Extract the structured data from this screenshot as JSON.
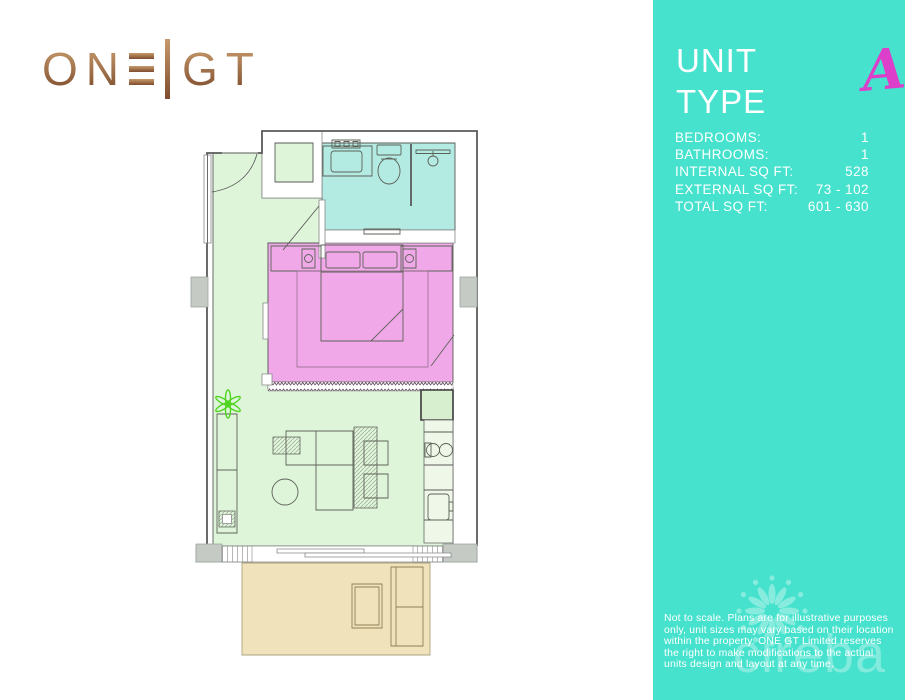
{
  "logo": {
    "left": "ON",
    "right": "GT"
  },
  "icons": {
    "logo_e_glyph": "three-horizontal-bars-E",
    "logo_divider": "tall-vertical-bar",
    "watermark_flower": "petal-flower-logo",
    "plant": "plant-top-view"
  },
  "sidebar": {
    "title": "UNIT TYPE",
    "unit_letter": "A",
    "details": [
      {
        "label": "BEDROOMS:",
        "value": "1"
      },
      {
        "label": "BATHROOMS:",
        "value": "1"
      },
      {
        "label": "INTERNAL SQ FT:",
        "value": "528"
      },
      {
        "label": "EXTERNAL SQ FT:",
        "value": "73 - 102"
      },
      {
        "label": "TOTAL SQ FT:",
        "value": "601 - 630"
      }
    ],
    "disclaimer": "Not to scale. Plans are for illustrative purposes only, unit sizes may vary based on their location within the property. ONE GT Limited reserves the right to make modifications to the actual units design and layout at any time.",
    "watermark_text": "cireba"
  },
  "colors": {
    "teal": "#46E2CD",
    "accent_pink": "#DC3FC9",
    "logo_copper_light": "#C79A6B",
    "logo_copper_dark": "#7E4D2E",
    "bedroom_pink": "#F0A8E8",
    "living_green": "#DFF5DA",
    "bathroom_cyan": "#B3EBE3",
    "balcony_beige": "#F0E3BC",
    "wall_gray": "#C5CAC5",
    "wall_line": "#5A5A5A",
    "plant_green": "#4FD41F",
    "zigzag_purple": "#6B5566"
  }
}
